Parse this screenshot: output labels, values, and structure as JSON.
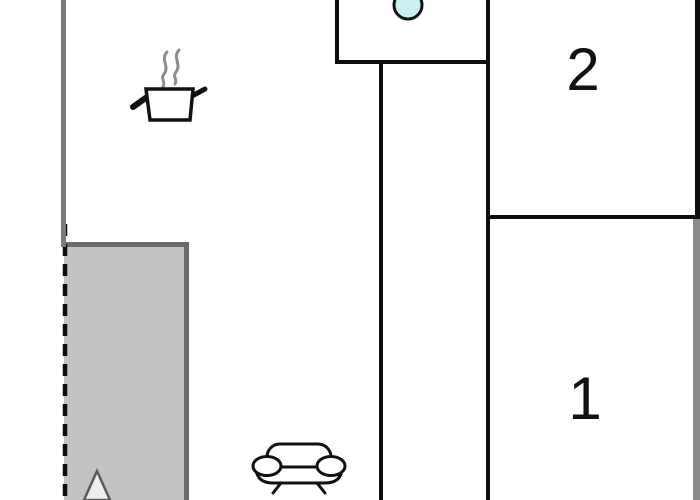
{
  "floorplan": {
    "title": "apartment-floor-plan",
    "rooms": [
      {
        "id": "room-2",
        "label": "2"
      },
      {
        "id": "room-1",
        "label": "1"
      }
    ],
    "areas": [
      {
        "id": "kitchen",
        "icon": "stove-pot-icon"
      },
      {
        "id": "bathroom",
        "icon": "sink-icon"
      },
      {
        "id": "living-area",
        "icon": "sofa-icon"
      },
      {
        "id": "terrace",
        "icon": "tree-icon"
      }
    ],
    "icons": [
      "stove-pot-icon",
      "steam-icon",
      "sink-icon",
      "sofa-icon",
      "tree-icon"
    ],
    "colors": {
      "background": "#ffffff",
      "wall_black": "#0d0d0d",
      "wall_gray": "#7b7b7b",
      "terrace_border": "#6a6a6a",
      "terrace_fill": "#c2c2c2",
      "right_wall_gray": "#8b8b8b",
      "sink_fill": "#c9f1f0",
      "steam_gray": "#8d8d8d",
      "tree_fill": "#eeeeee",
      "tree_stroke": "#5a5a5a",
      "icon_stroke": "#111111",
      "label_color": "#111111"
    }
  }
}
